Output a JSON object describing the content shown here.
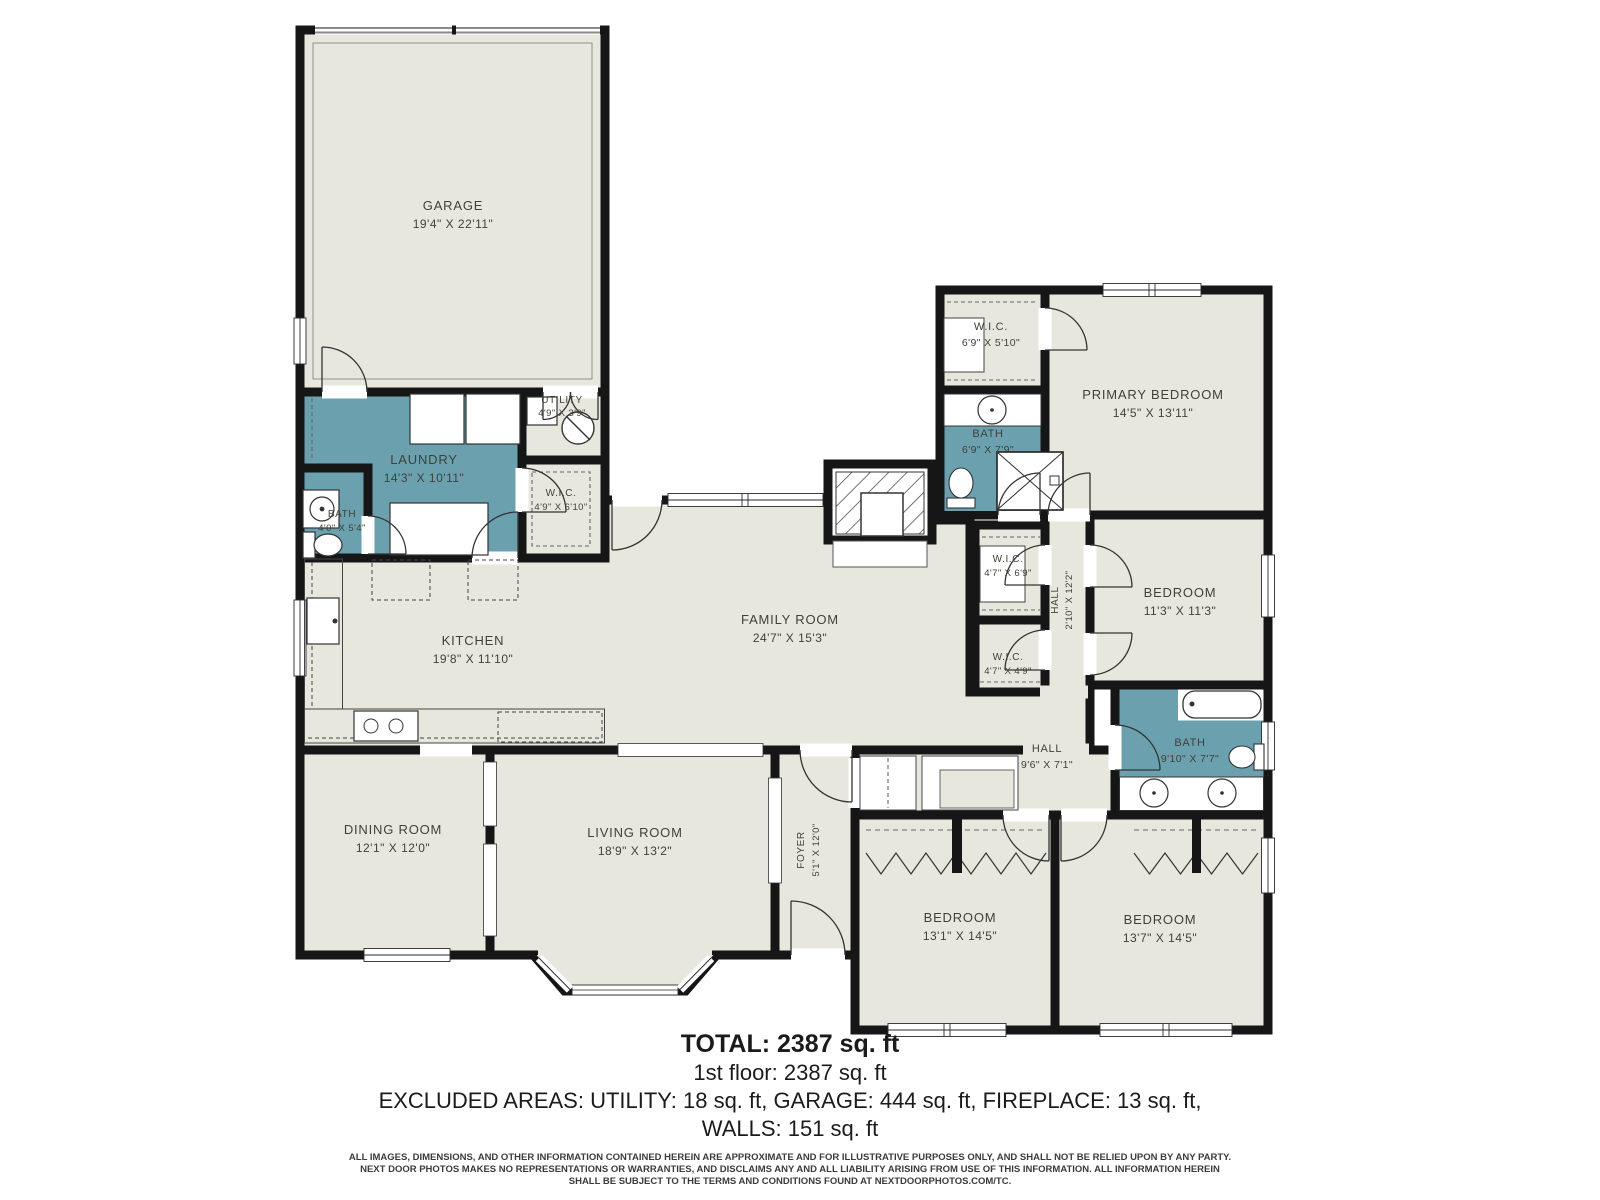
{
  "colors": {
    "room_fill": "#e8e7dd",
    "wet_room_fill": "#6ba1ae",
    "wall": "#161616",
    "label_text": "#3f4138",
    "summary_text": "#1b1b1b",
    "disclaimer_text": "#3b3b3b",
    "garage_door": "#8a8a8a"
  },
  "rooms": [
    {
      "id": "garage",
      "name": "GARAGE",
      "dims": "19'4\" X 22'11\""
    },
    {
      "id": "utility",
      "name": "UTILITY",
      "dims": "4'9\" X 3'9\""
    },
    {
      "id": "laundry",
      "name": "LAUNDRY",
      "dims": "14'3\" X 10'11\""
    },
    {
      "id": "bath-laundry",
      "name": "BATH",
      "dims": "4'0\" X 5'4\""
    },
    {
      "id": "wic-laundry",
      "name": "W.I.C.",
      "dims": "4'9\" X 6'10\""
    },
    {
      "id": "wic-primary",
      "name": "W.I.C.",
      "dims": "6'9\" X 5'10\""
    },
    {
      "id": "bath-primary",
      "name": "BATH",
      "dims": "6'9\" X 7'9\""
    },
    {
      "id": "primary-bedroom",
      "name": "PRIMARY BEDROOM",
      "dims": "14'5\" X 13'11\""
    },
    {
      "id": "wic-hall-upper",
      "name": "W.I.C.",
      "dims": "4'7\" X 6'9\""
    },
    {
      "id": "hall-upper",
      "name": "HALL",
      "dims": "2'10\" X 12'2\""
    },
    {
      "id": "bedroom-ne",
      "name": "BEDROOM",
      "dims": "11'3\" X 11'3\""
    },
    {
      "id": "wic-hall-lower",
      "name": "W.I.C.",
      "dims": "4'7\" X 4'9\""
    },
    {
      "id": "family-room",
      "name": "FAMILY ROOM",
      "dims": "24'7\" X 15'3\""
    },
    {
      "id": "kitchen",
      "name": "KITCHEN",
      "dims": "19'8\" X 11'10\""
    },
    {
      "id": "bath-hall",
      "name": "BATH",
      "dims": "9'10\" X 7'7\""
    },
    {
      "id": "hall-lower",
      "name": "HALL",
      "dims": "9'6\" X 7'1\""
    },
    {
      "id": "dining-room",
      "name": "DINING ROOM",
      "dims": "12'1\" X 12'0\""
    },
    {
      "id": "living-room",
      "name": "LIVING ROOM",
      "dims": "18'9\" X 13'2\""
    },
    {
      "id": "foyer",
      "name": "FOYER",
      "dims": "5'1\" X 12'0\""
    },
    {
      "id": "bedroom-sw",
      "name": "BEDROOM",
      "dims": "13'1\" X 14'5\""
    },
    {
      "id": "bedroom-se",
      "name": "BEDROOM",
      "dims": "13'7\" X 14'5\""
    }
  ],
  "summary": {
    "total": "TOTAL: 2387 sq. ft",
    "floor": "1st floor: 2387 sq. ft",
    "excluded": "EXCLUDED AREAS: UTILITY: 18 sq. ft, GARAGE: 444 sq. ft, FIREPLACE: 13 sq. ft,",
    "walls": "WALLS: 151 sq. ft"
  },
  "disclaimer": {
    "line1": "ALL IMAGES, DIMENSIONS, AND OTHER INFORMATION CONTAINED HEREIN ARE APPROXIMATE AND FOR ILLUSTRATIVE PURPOSES ONLY, AND SHALL NOT BE RELIED UPON BY ANY PARTY.",
    "line2": "NEXT DOOR PHOTOS MAKES NO REPRESENTATIONS OR WARRANTIES, AND DISCLAIMS ANY AND ALL LIABILITY ARISING FROM USE OF THIS INFORMATION. ALL INFORMATION HEREIN",
    "line3": "SHALL BE SUBJECT TO THE TERMS AND CONDITIONS FOUND AT NEXTDOORPHOTOS.COM/TC."
  }
}
